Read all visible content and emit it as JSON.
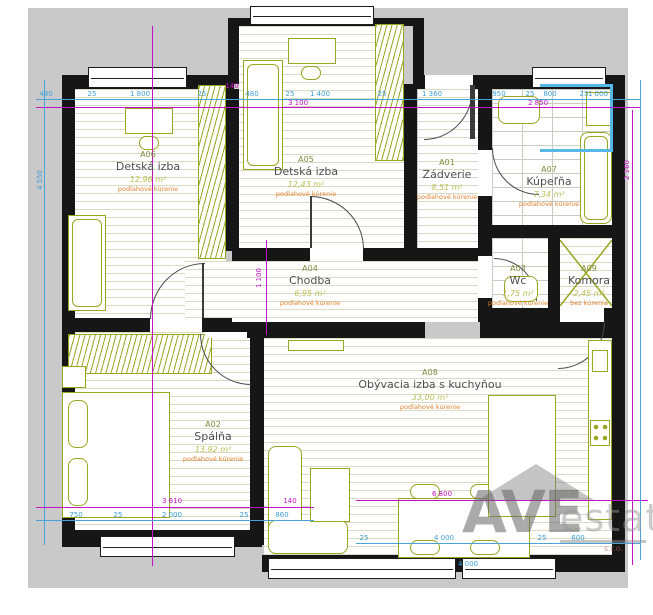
{
  "plan_title": "Apartment floor plan",
  "colors": {
    "wall": "#161616",
    "furniture": "#9aa520",
    "dimension_blue": "#3f9fd8",
    "dimension_magenta": "#c312c3",
    "heating_note": "#e0812e",
    "exterior": "#c9c9c9"
  },
  "rooms": [
    {
      "code": "A06",
      "name": "Detská izba",
      "area": "12,96 m²",
      "note": "podlahové kúrenie",
      "x": 148,
      "y": 150
    },
    {
      "code": "A05",
      "name": "Detská izba",
      "area": "12,43 m²",
      "note": "podlahové kúrenie",
      "x": 306,
      "y": 155
    },
    {
      "code": "A01",
      "name": "Zádverie",
      "area": "8,51 m²",
      "note": "podlahové kúrenie",
      "x": 447,
      "y": 158
    },
    {
      "code": "A07",
      "name": "Kúpeľňa",
      "area": "7,34 m²",
      "note": "podlahové kúrenie",
      "x": 549,
      "y": 165
    },
    {
      "code": "A04",
      "name": "Chodba",
      "area": "6,95 m²",
      "note": "podlahové kúrenie",
      "x": 310,
      "y": 264
    },
    {
      "code": "A03",
      "name": "Wc",
      "area": "1,75 m²",
      "note": "podlahové kúrenie",
      "x": 518,
      "y": 264
    },
    {
      "code": "A09",
      "name": "Komora",
      "area": "2,45 m²",
      "note": "bez kúrenia",
      "x": 589,
      "y": 264
    },
    {
      "code": "A08",
      "name": "Obývacia izba s kuchyňou",
      "area": "33,00 m²",
      "note": "podlahové kúrenie",
      "x": 430,
      "y": 368
    },
    {
      "code": "A02",
      "name": "Spálňa",
      "area": "13,92 m²",
      "note": "podlahové kúrenie",
      "x": 213,
      "y": 420
    }
  ],
  "dimensions": [
    {
      "t": "480",
      "x": 46,
      "y": 90
    },
    {
      "t": "25",
      "x": 92,
      "y": 90
    },
    {
      "t": "1 800",
      "x": 140,
      "y": 90
    },
    {
      "t": "25",
      "x": 202,
      "y": 90
    },
    {
      "t": "140",
      "x": 232,
      "y": 82,
      "c": "m"
    },
    {
      "t": "480",
      "x": 252,
      "y": 90
    },
    {
      "t": "25",
      "x": 290,
      "y": 90
    },
    {
      "t": "1 400",
      "x": 320,
      "y": 90
    },
    {
      "t": "25",
      "x": 382,
      "y": 90
    },
    {
      "t": "1 360",
      "x": 432,
      "y": 90
    },
    {
      "t": "950",
      "x": 499,
      "y": 90
    },
    {
      "t": "25",
      "x": 530,
      "y": 90
    },
    {
      "t": "800",
      "x": 550,
      "y": 90
    },
    {
      "t": "25",
      "x": 584,
      "y": 90
    },
    {
      "t": "1 000",
      "x": 598,
      "y": 90
    },
    {
      "t": "3 100",
      "x": 298,
      "y": 99,
      "c": "m"
    },
    {
      "t": "2 850",
      "x": 538,
      "y": 99,
      "c": "m"
    },
    {
      "t": "4 550",
      "x": 40,
      "y": 180,
      "v": true
    },
    {
      "t": "1 100",
      "x": 259,
      "y": 278,
      "c": "m",
      "v": true
    },
    {
      "t": "2 160",
      "x": 627,
      "y": 170,
      "c": "m",
      "v": true
    },
    {
      "t": "3 610",
      "x": 172,
      "y": 497,
      "c": "m"
    },
    {
      "t": "140",
      "x": 290,
      "y": 497,
      "c": "m"
    },
    {
      "t": "750",
      "x": 76,
      "y": 511
    },
    {
      "t": "25",
      "x": 118,
      "y": 511
    },
    {
      "t": "2 000",
      "x": 172,
      "y": 511
    },
    {
      "t": "25",
      "x": 244,
      "y": 511
    },
    {
      "t": "860",
      "x": 282,
      "y": 511
    },
    {
      "t": "6 800",
      "x": 442,
      "y": 490,
      "c": "m"
    },
    {
      "t": "25",
      "x": 364,
      "y": 534
    },
    {
      "t": "4 000",
      "x": 444,
      "y": 534
    },
    {
      "t": "25",
      "x": 542,
      "y": 534
    },
    {
      "t": "600",
      "x": 578,
      "y": 534
    },
    {
      "t": "4 000",
      "x": 468,
      "y": 560
    }
  ],
  "watermark": {
    "word1": "AVE",
    "word2": "estate",
    "word3": "s.r.o."
  }
}
